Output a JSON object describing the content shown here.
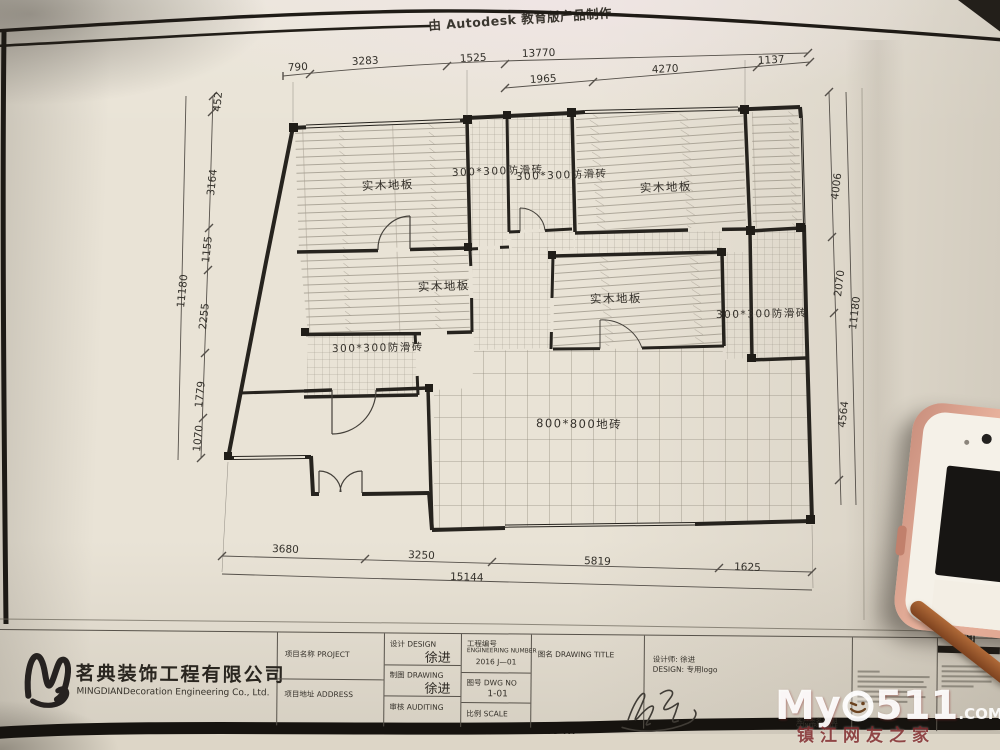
{
  "sheet": {
    "autodesk_watermark_top": "由 Autodesk 教育版产品制作",
    "autodesk_watermark_bottom": "由 Autodesk 教育版产品制作",
    "partial_sheet_title": "地面"
  },
  "plan": {
    "rooms": {
      "bedroom_top_left": "实木地板",
      "bath_top_a": "300*300防滑砖",
      "bath_top_b": "300*300防滑砖",
      "bedroom_top_right": "实木地板",
      "bedroom_mid_left": "实木地板",
      "room_mid_right": "实木地板",
      "bath_mid_left": "300*300防滑砖",
      "bath_right": "300*300防滑砖",
      "living": "800*800地砖"
    },
    "dimensions": {
      "top_row1": [
        "790",
        "3283",
        "1525"
      ],
      "top_row1_overall": "13770",
      "top_row2": [
        "1965",
        "4270",
        "1137"
      ],
      "left": [
        "452",
        "3164",
        "1155",
        "2255",
        "1779",
        "1070"
      ],
      "left_overall": "11180",
      "right": [
        "4006",
        "2070",
        "4564"
      ],
      "right_overall": "11180",
      "bottom": [
        "3680",
        "3250",
        "5819",
        "1625"
      ],
      "bottom_overall": "15144"
    }
  },
  "title_block": {
    "company_name_cn": "茗典装饰工程有限公司",
    "company_name_en": "MINGDIANDecoration Engineering Co., Ltd.",
    "project_label": "项目名称 PROJECT",
    "address_label": "项目地址 ADDRESS",
    "design_label": "设计 DESIGN",
    "design_value": "徐进",
    "draft_label": "制图 DRAWING",
    "draft_value": "徐进",
    "audit_label": "审核 AUDITING",
    "eng_no_label_cn": "工程编号",
    "eng_no_label_en": "ENGINEERING NUMBER",
    "eng_no_value": "2016 J—01",
    "dwg_no_label": "图号 DWG NO",
    "dwg_no_value": "1-01",
    "scale_label": "比例 SCALE",
    "drawing_title_label": "图名 DRAWING TITLE",
    "designer_label": "设计师: 徐进",
    "design_logo_label": "DESIGN: 专用logo",
    "confirm_label_cn": "客户签名/日期",
    "confirm_label_en": "CONFIRM/DATE"
  },
  "watermark": {
    "part1": "My",
    "part2": "511",
    "com": ".COM",
    "tagline": "镇江网友之家",
    "accent_red": "#8e2a2e"
  },
  "colors": {
    "paper": "#e9e3d6",
    "ink": "#2b2721",
    "rose_gold": "#e0a18c"
  }
}
